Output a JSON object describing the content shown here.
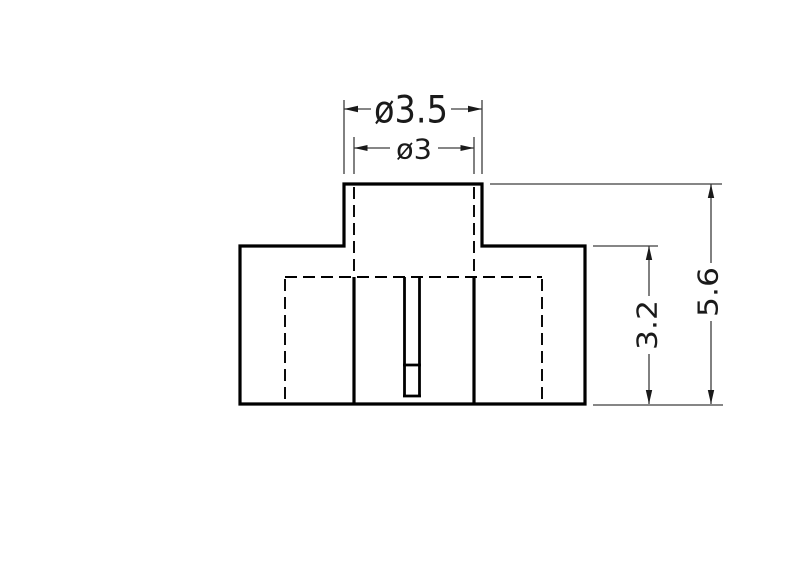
{
  "page": {
    "background": "#ffffff"
  },
  "drawing": {
    "colors": {
      "outline": "#000000",
      "dimension_lines": "#3d3d3d",
      "label_text": "#1a1a1a"
    },
    "dimensions": {
      "outer_diameter": {
        "label": "ø3.5"
      },
      "inner_diameter": {
        "label": "ø3"
      },
      "body_height": {
        "label": "3.2"
      },
      "overall_height": {
        "label": "5.6"
      }
    }
  }
}
